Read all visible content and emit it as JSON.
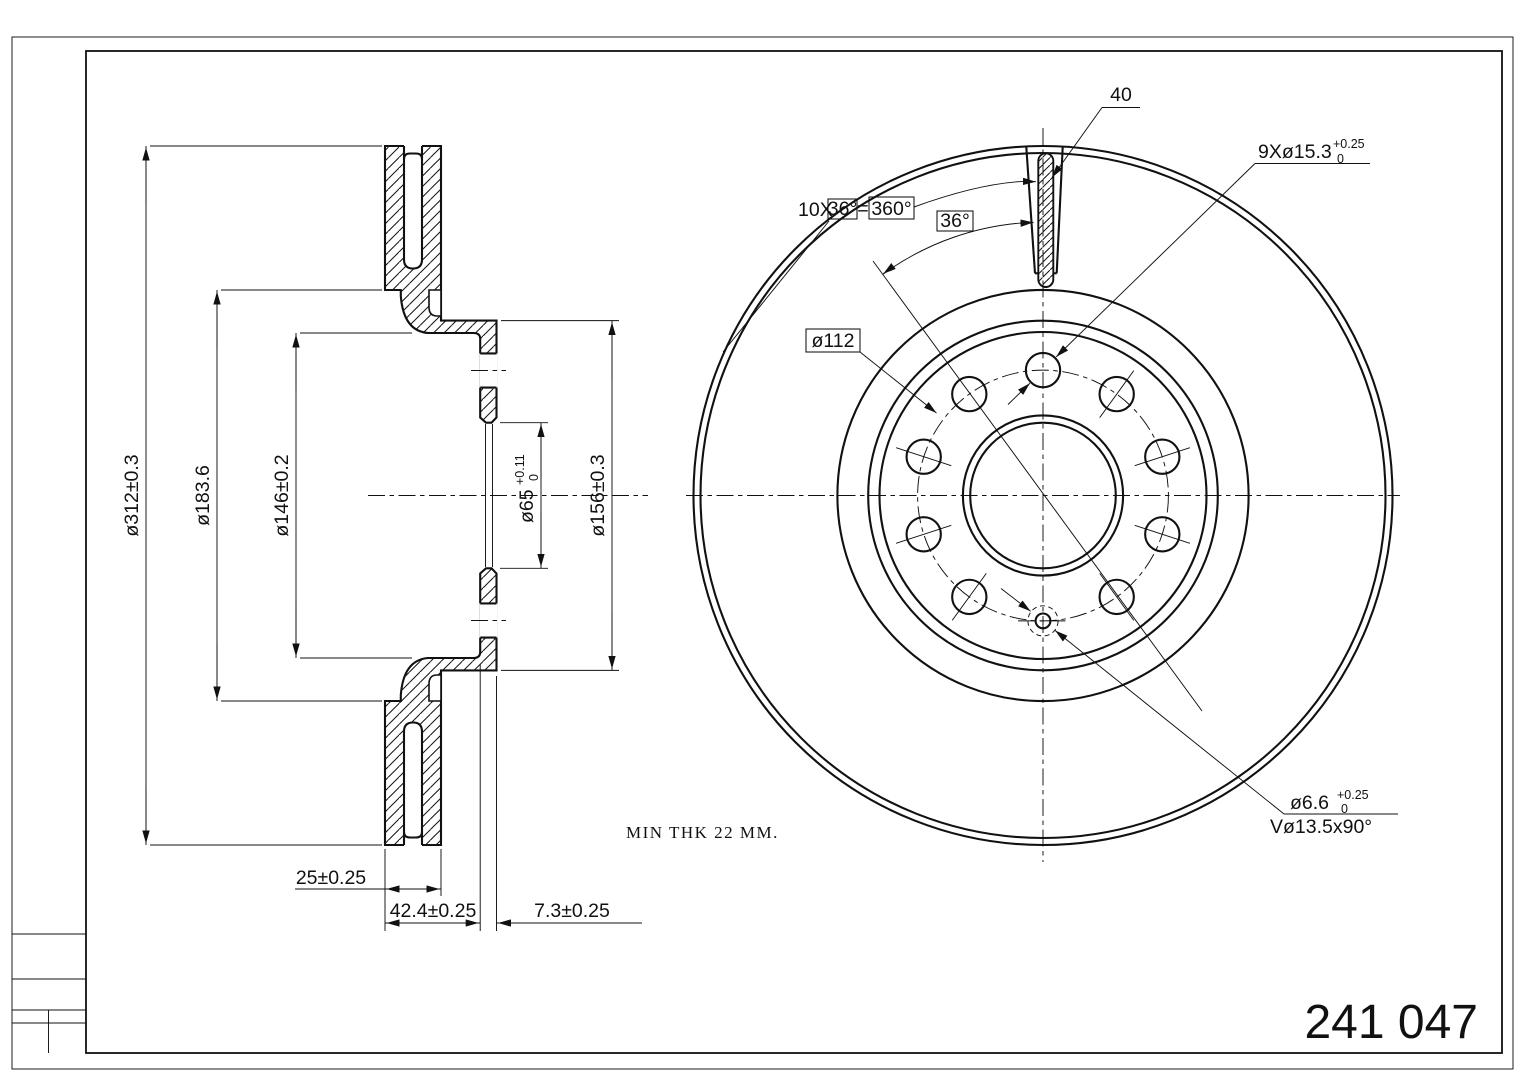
{
  "title_block": {
    "part_number": "241 047"
  },
  "notes": {
    "min_thickness": "MIN THK 22 MM."
  },
  "section_view": {
    "outer_diameter": "ø312±0.3",
    "ring_inner_diameter": "ø183.6",
    "hat_inner_diameter": "ø146±0.2",
    "bore_diameter": "ø65",
    "bore_tol_upper": "+0.11",
    "bore_tol_lower": "0",
    "hat_outer_diameter": "ø156±0.3",
    "disc_thickness": "25±0.25",
    "overall_height": "42.4±0.25",
    "flange_thickness": "7.3±0.25"
  },
  "front_view": {
    "slot_label": "40",
    "spacing_prefix": "10X",
    "spacing_angle": "36°",
    "spacing_equals": "=",
    "spacing_total": "360°",
    "angle_label": "36°",
    "bolt_circle": "ø112",
    "bolt_holes": "9Xø15.3",
    "bolt_holes_tol_upper": "+0.25",
    "bolt_holes_tol_lower": "0",
    "pin_hole": "ø6.6",
    "pin_hole_tol_upper": "+0.25",
    "pin_hole_tol_lower": "0",
    "countersink": "Vø13.5x90°"
  }
}
